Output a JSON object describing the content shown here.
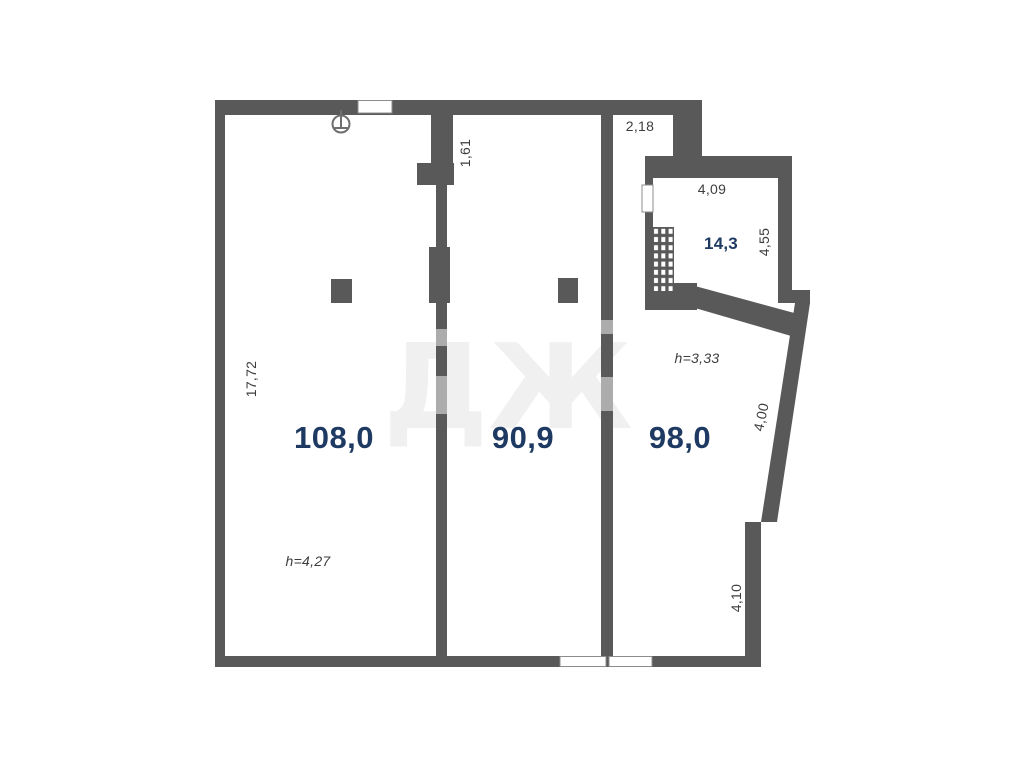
{
  "plan": {
    "type": "apartment-floor-plan",
    "rooms": {
      "room_108": {
        "area": "108,0",
        "ceiling_height": "h=4,27"
      },
      "room_90_9": {
        "area": "90,9"
      },
      "room_98": {
        "area": "98,0",
        "ceiling_height": "h=3,33"
      },
      "room_14_3": {
        "area": "14,3"
      }
    },
    "dimensions": {
      "passage_width": "2,18",
      "room_14_3_width": "4,09",
      "room_14_3_depth": "4,55",
      "niche_depth": "1,61",
      "left_wall": "17,72",
      "slanted_wall": "4,00",
      "lower_right_wall": "4,10"
    },
    "watermark_text": "ДЖ",
    "icons": [
      "ground-symbol-icon",
      "window-opening",
      "hatched-shaft"
    ],
    "colors": {
      "wall": "#595959",
      "room_label": "#1e3a62",
      "dimension_text": "#3d3d3d",
      "window_outline": "#8c8c8c",
      "background": "#ffffff",
      "watermark": "#eeeeee"
    }
  }
}
